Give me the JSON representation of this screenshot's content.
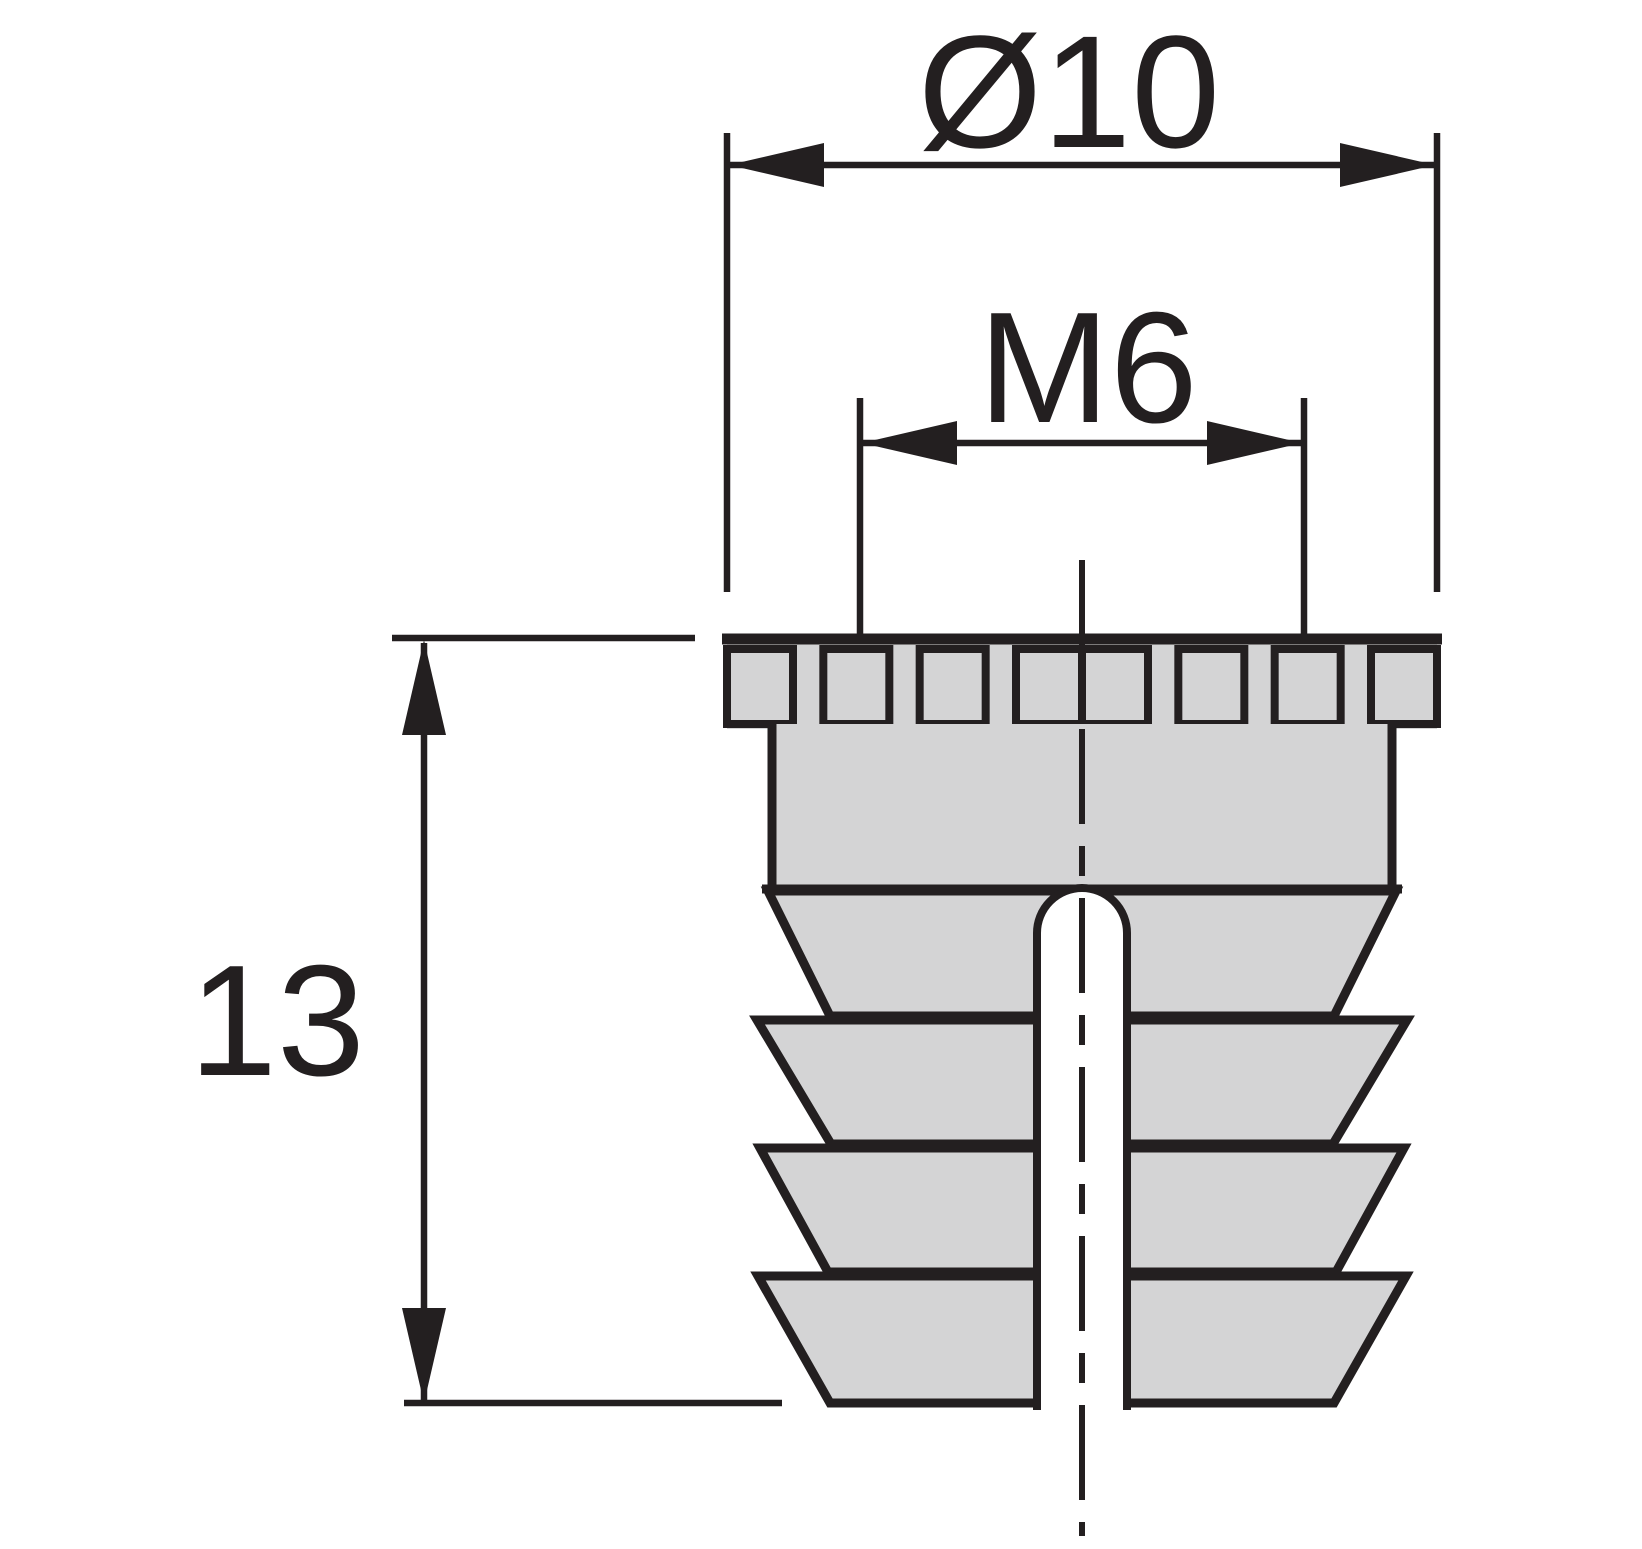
{
  "drawing": {
    "type": "technical-dimension-drawing",
    "subject": "threaded-furniture-insert-side-view",
    "dimensions": {
      "diameter": {
        "label": "Ø10"
      },
      "thread": {
        "label": "M6"
      },
      "length": {
        "label": "13"
      }
    },
    "colors": {
      "line": "#231f20",
      "part_fill": "#d4d4d5",
      "background": "#ffffff"
    }
  }
}
